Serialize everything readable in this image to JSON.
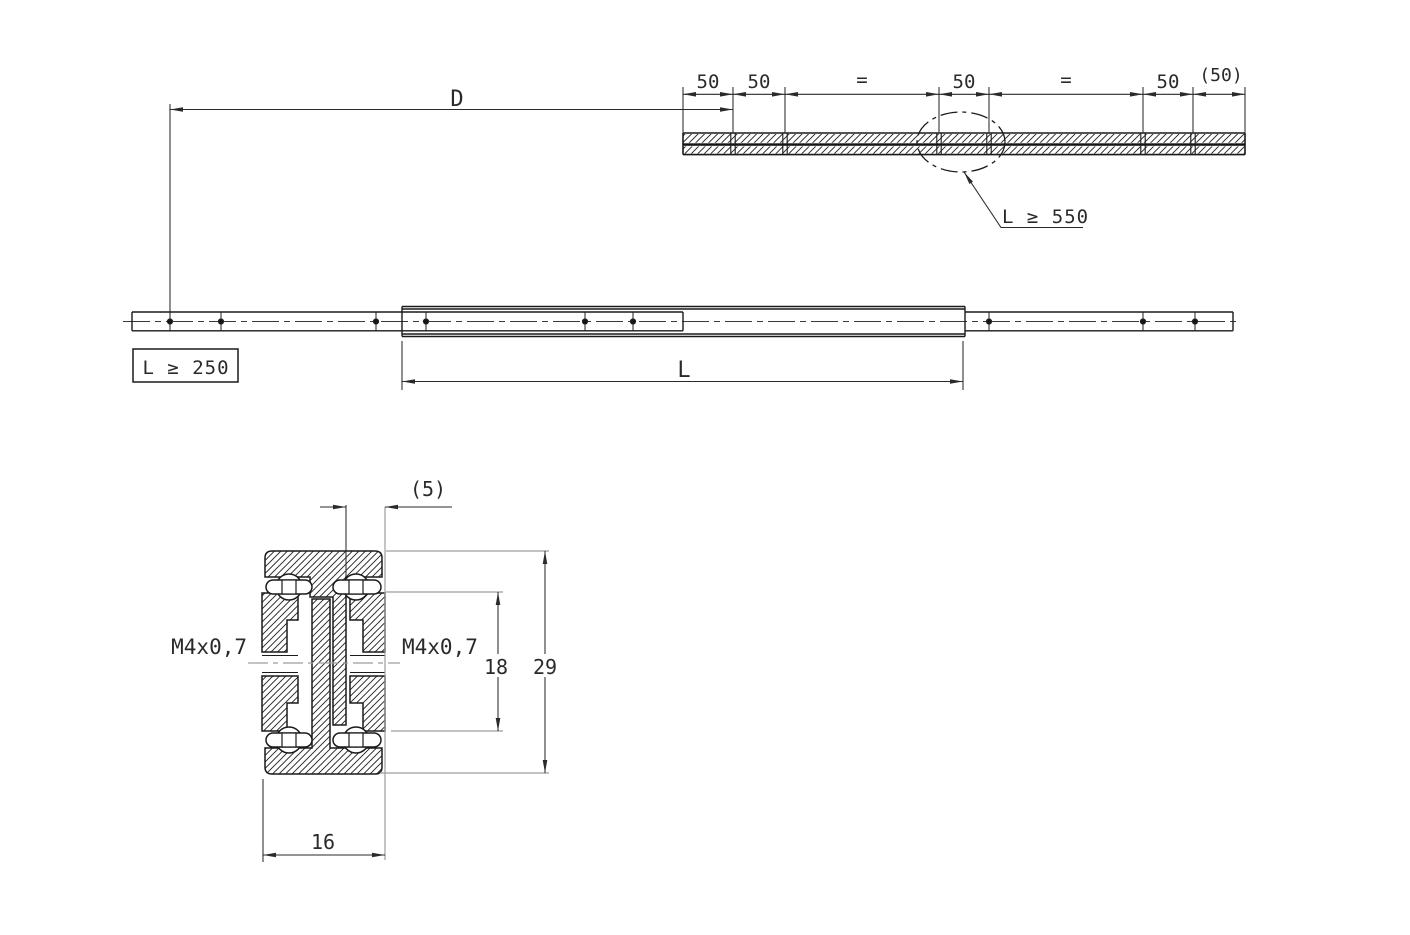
{
  "title": "Telescopic slide rail drawing",
  "colors": {
    "line": "#1a1a1a",
    "dim": "#2a2a2a",
    "reference_gray": "#9e9e9e",
    "background": "#ffffff"
  },
  "top_view": {
    "labels": [
      "50",
      "50",
      "=",
      "50",
      "=",
      "50",
      "(50)"
    ],
    "detail_note": "L ≥ 550"
  },
  "overall": {
    "d_label": "D"
  },
  "side_view": {
    "min_note": "L ≥ 250",
    "length_label": "L"
  },
  "section": {
    "offset": "(5)",
    "thread_left": "M4x0,7",
    "thread_right": "M4x0,7",
    "height_inner": "18",
    "height_outer": "29",
    "width": "16"
  }
}
